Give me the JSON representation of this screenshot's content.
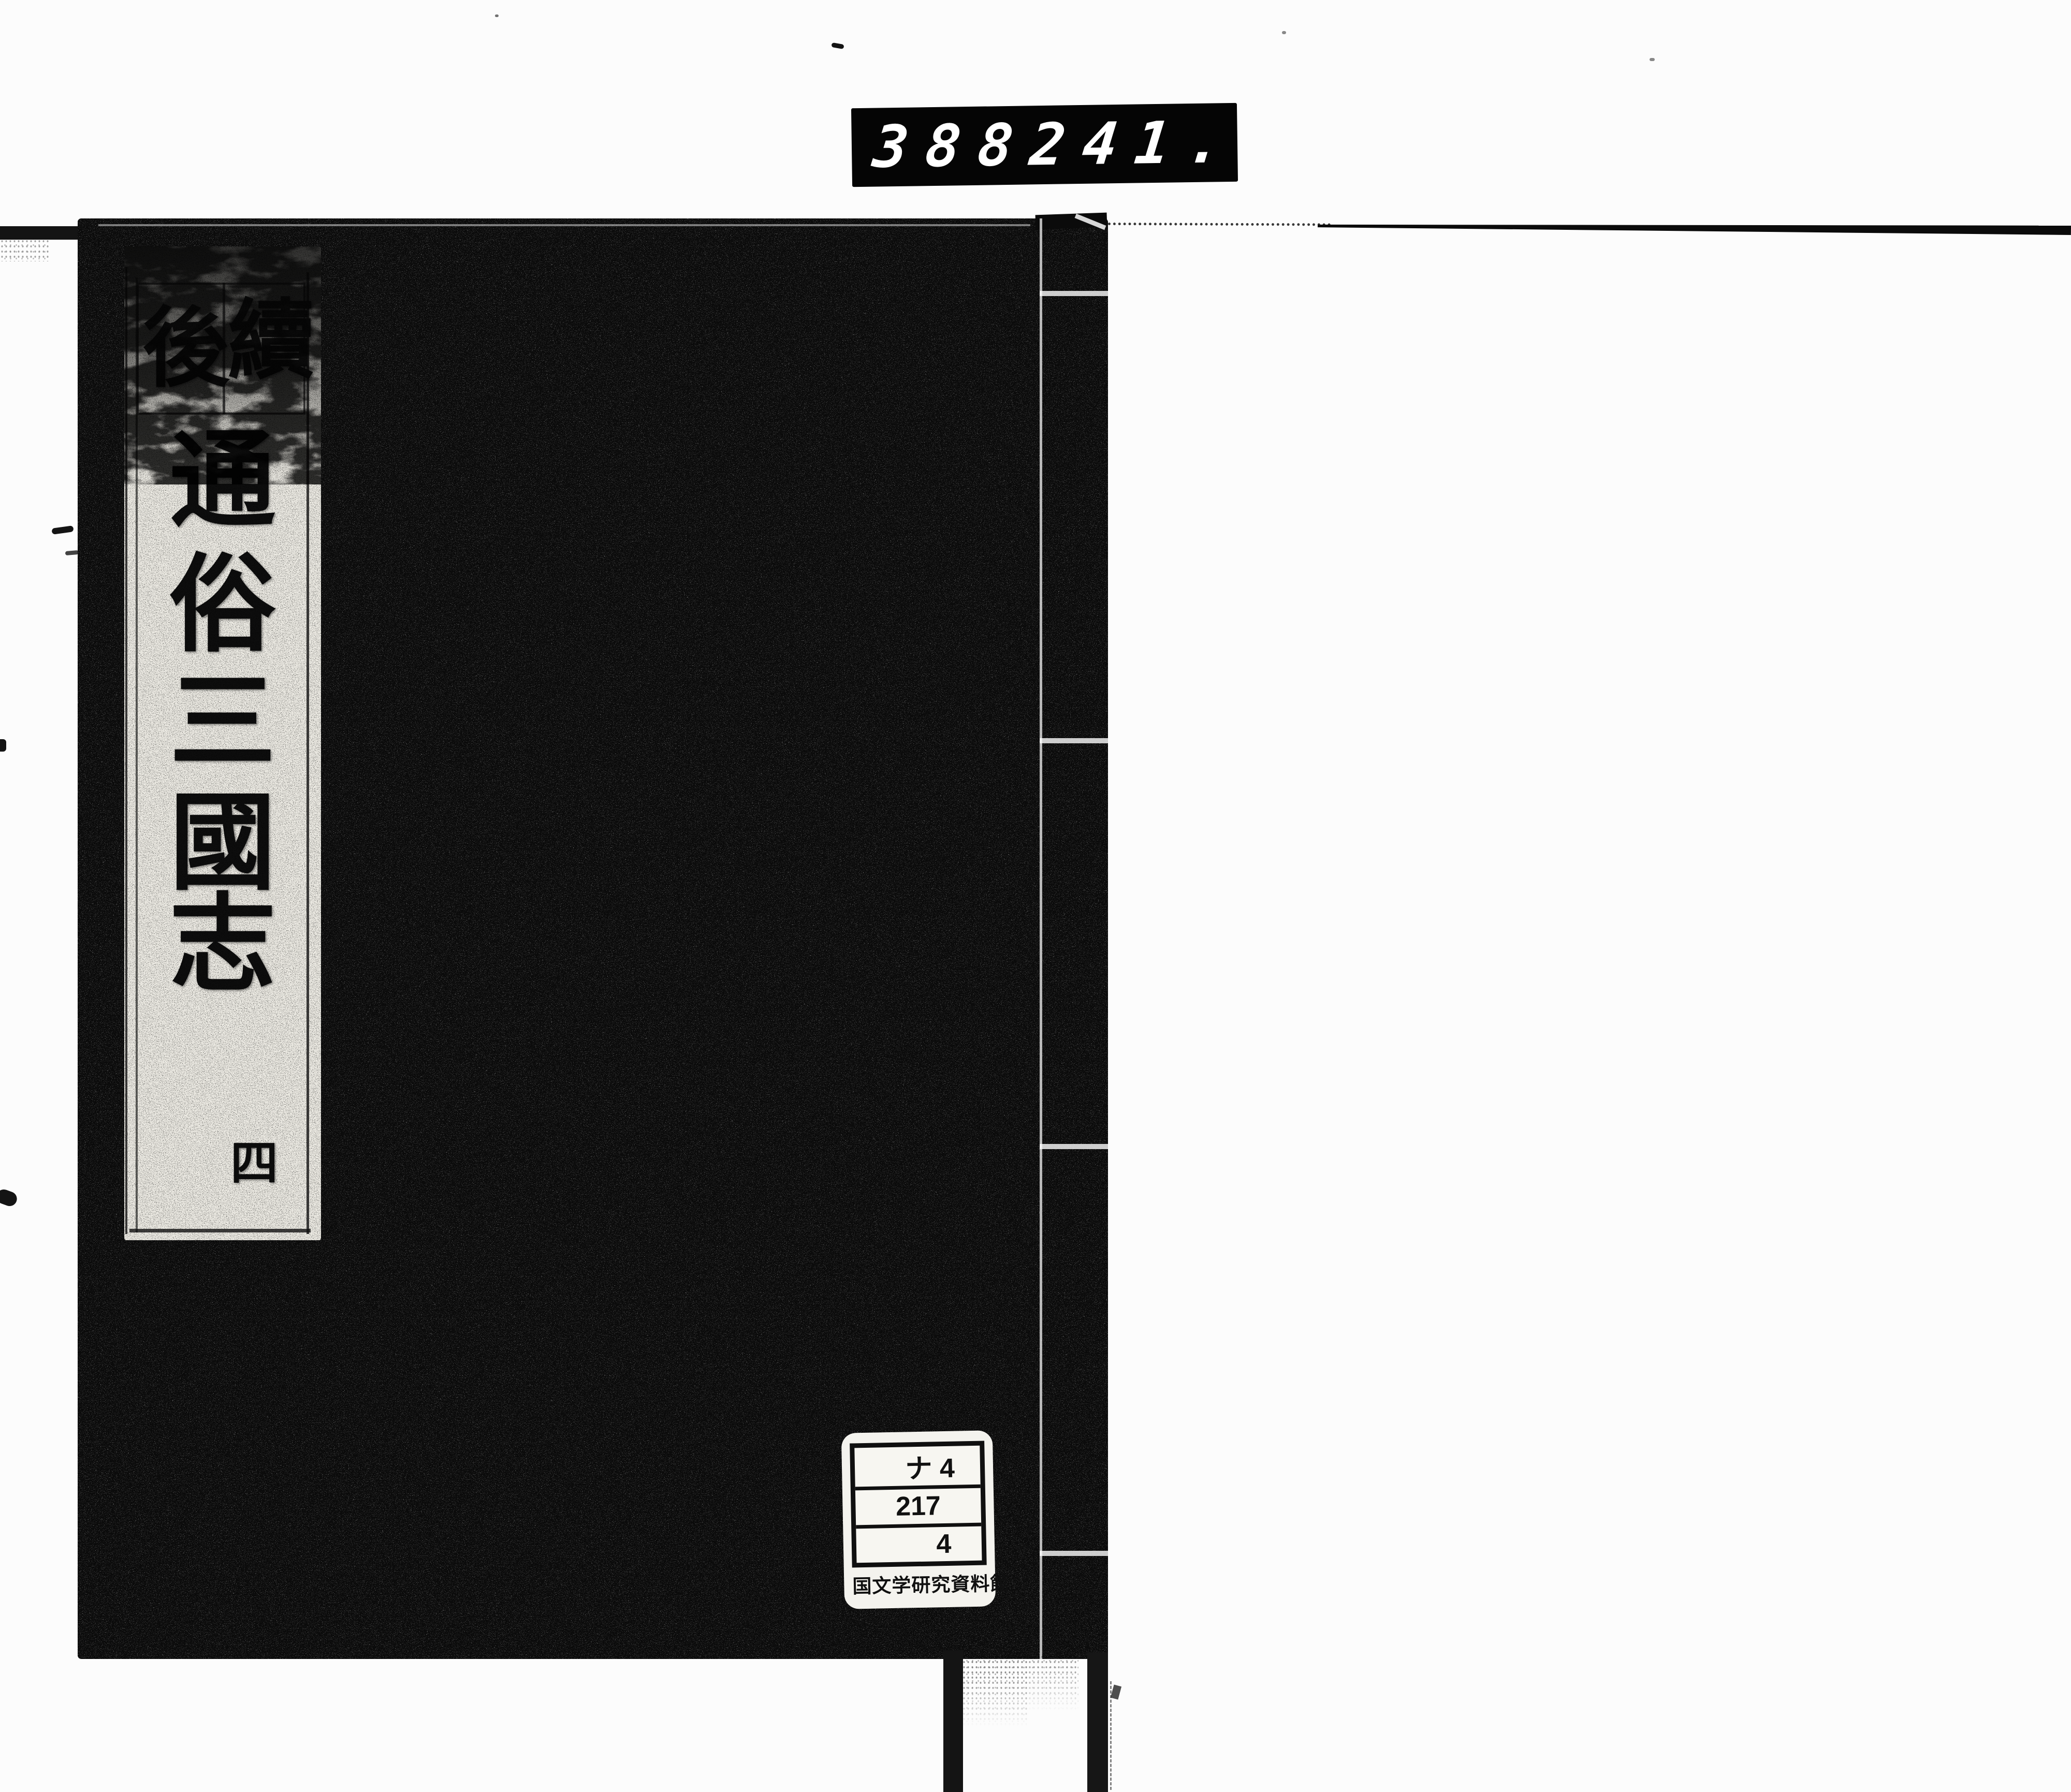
{
  "document": {
    "counter_display": {
      "group_left": "388",
      "group_right": "241."
    },
    "book": {
      "title_slip": {
        "header_chars_right_to_left": [
          "續",
          "後"
        ],
        "main_title": "通俗三國志",
        "main_title_vertical": [
          "通",
          "俗",
          "三",
          "國",
          "志"
        ],
        "volume_char": "四"
      },
      "library_label": {
        "call_number_rows": [
          "ナ 4",
          "217",
          "4"
        ],
        "institution": "国文学研究資料館"
      }
    },
    "colors": {
      "page_background": "#fcfcfc",
      "cover": "#0b0b0b",
      "slip_paper": "#e9e7e0",
      "label_paper": "#f4f3ee",
      "counter_background": "#050505",
      "counter_digits": "#ffffff"
    }
  }
}
